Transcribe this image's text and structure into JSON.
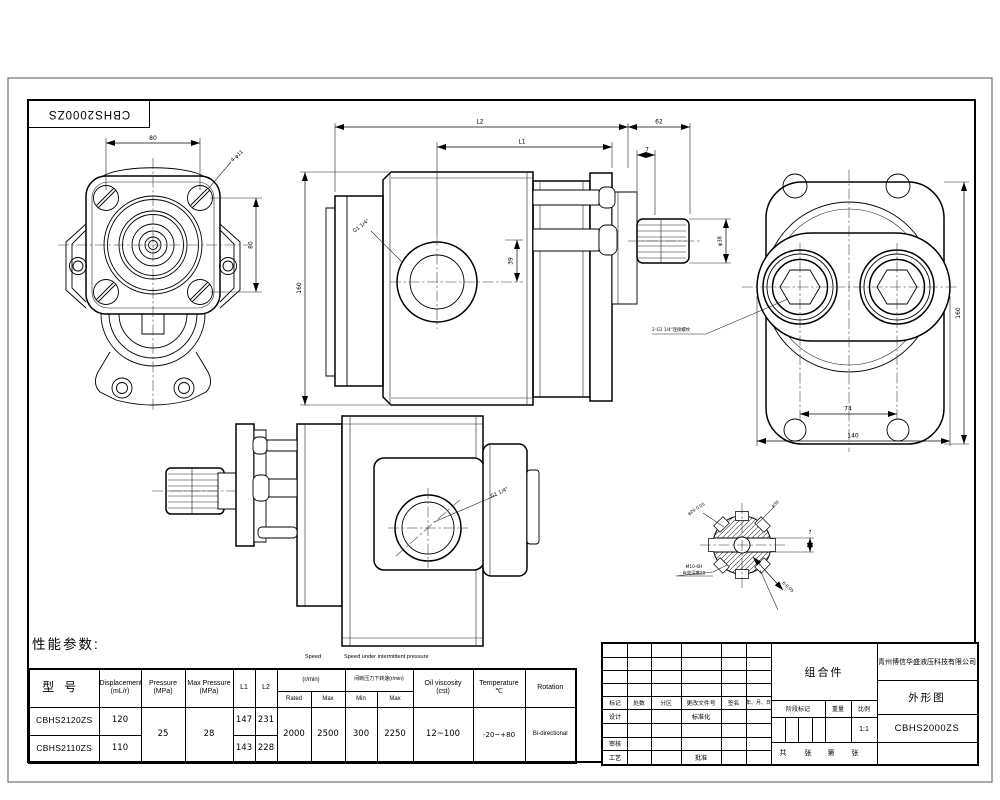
{
  "sheet": {
    "corner_model": "CBHS2000ZS"
  },
  "views": {
    "front": {
      "dim_width": "80",
      "dim_height": "80",
      "leader_holes": "4-φ11"
    },
    "side": {
      "dim_l2": "L2",
      "dim_62": "62",
      "dim_l1": "L1",
      "dim_7": "7",
      "dim_height": "160",
      "dim_39": "39",
      "dim_shaft": "φ38",
      "leader_port": "G1 1/4\""
    },
    "rear": {
      "dim_ports": "74",
      "dim_width": "140",
      "dim_height": "160",
      "leader_ports": "2-G1 1/4\"连接螺纹"
    },
    "lateral": {
      "leader_port": "G1 1/4\""
    },
    "detail": {
      "dia_root": "φ26-0.05",
      "dia_outer": "φ30",
      "dim_slot": "7",
      "thread": "M10-6H",
      "thread_depth": "有效深度20",
      "key_width": "6-0.05"
    }
  },
  "perf": {
    "title": "性能参数:",
    "caption_speed": "Speed",
    "caption_intermittent": "Speed under intermittent pressure",
    "h_model": "型号",
    "h_displacement": "Displacement",
    "h_displacement_u": "(mL/r)",
    "h_pressure": "Pressure",
    "h_pressure_u": "(MPa)",
    "h_max_pressure": "Max Pressure",
    "h_max_pressure_u": "(MPa)",
    "h_l1": "L1",
    "h_l2": "L2",
    "h_speed_group": "(r/min)",
    "h_intermittent_group": "间断压力下转速(r/min)",
    "h_rated": "Rated",
    "h_max": "Max",
    "h_min": "Min",
    "h_max2": "Max",
    "h_viscosity": "Oil viscosity",
    "h_viscosity_u": "(cst)",
    "h_temperature": "Temperature",
    "h_temperature_u": "℃",
    "h_rotation": "Rotation",
    "rows": [
      {
        "model": "CBHS2120ZS",
        "displacement": "120",
        "l1": "147",
        "l2": "231"
      },
      {
        "model": "CBHS2110ZS",
        "displacement": "110",
        "l1": "143",
        "l2": "228"
      }
    ],
    "pressure": "25",
    "max_pressure": "28",
    "rated": "2000",
    "max": "2500",
    "min": "300",
    "max2": "2250",
    "viscosity": "12~100",
    "temperature": "-20~+80",
    "rotation": "Bi-directional"
  },
  "title_block": {
    "company": "青州博信华盛液压科技有限公司",
    "assembly": "组合件",
    "drawing_name": "外形图",
    "model": "CBHS2000ZS",
    "scale_value": "1:1",
    "mark": "标记",
    "count": "处数",
    "zone": "分区",
    "change_doc": "更改文件号",
    "sign": "签名",
    "date": "年、月、日",
    "design": "设计",
    "standardize": "标准化",
    "check": "审核",
    "process": "工艺",
    "approve": "批准",
    "stage_mark": "阶段标记",
    "weight": "重量",
    "scale": "比例",
    "total": "共",
    "sheet": "张",
    "number": "第",
    "sheet2": "张"
  }
}
